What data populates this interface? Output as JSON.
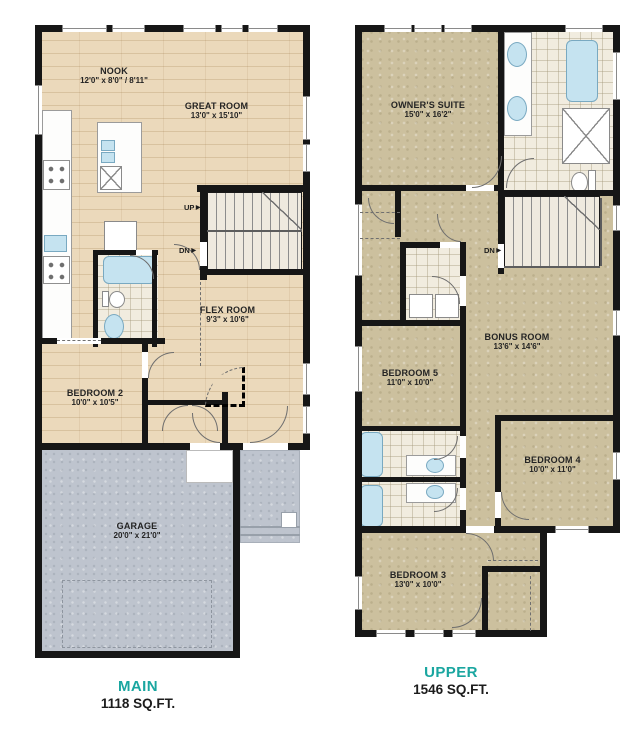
{
  "colors": {
    "teal": "#1AA6A0",
    "wall": "#161616",
    "wood": "#EBD9BB",
    "carpet": "#CCC09E",
    "concrete": "#BEC4CE",
    "tile": "#F1ECDF",
    "water": "#C5E3F0"
  },
  "icons": {
    "arrow_right": "▶"
  },
  "plans": [
    {
      "title": "MAIN",
      "area": "1118 SQ.FT.",
      "rooms": [
        {
          "name": "NOOK",
          "dims": "12'0\" x 8'0\" / 8'11\""
        },
        {
          "name": "GREAT ROOM",
          "dims": "13'0\" x 15'10\""
        },
        {
          "name": "FLEX ROOM",
          "dims": "9'3\" x 10'6\""
        },
        {
          "name": "BEDROOM 2",
          "dims": "10'0\" x 10'5\""
        },
        {
          "name": "GARAGE",
          "dims": "20'0\" x 21'0\""
        }
      ],
      "stairs": {
        "up": "UP",
        "down": "DN"
      }
    },
    {
      "title": "UPPER",
      "area": "1546 SQ.FT.",
      "rooms": [
        {
          "name": "OWNER'S SUITE",
          "dims": "15'0\" x 16'2\""
        },
        {
          "name": "BEDROOM 5",
          "dims": "11'0\" x 10'0\""
        },
        {
          "name": "BONUS ROOM",
          "dims": "13'6\" x 14'6\""
        },
        {
          "name": "BEDROOM 4",
          "dims": "10'0\" x 11'0\""
        },
        {
          "name": "BEDROOM 3",
          "dims": "13'0\" x 10'0\""
        }
      ],
      "stairs": {
        "down": "DN"
      }
    }
  ]
}
